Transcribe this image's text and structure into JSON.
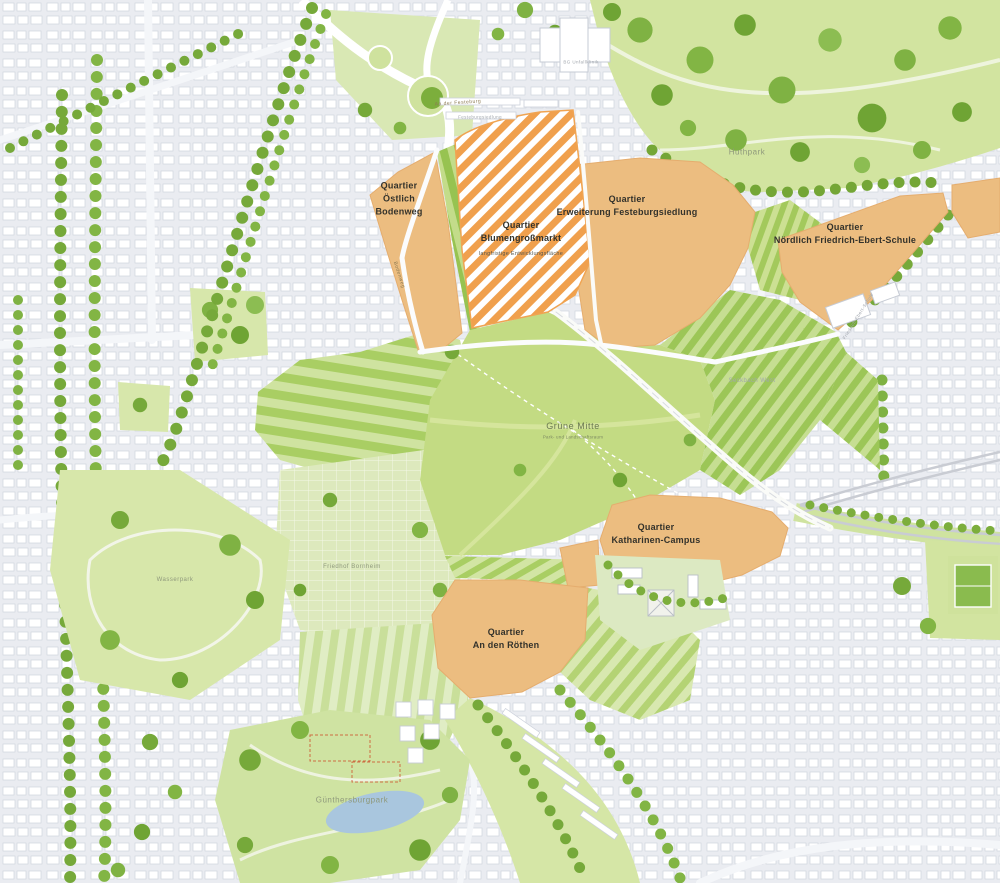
{
  "map": {
    "title": "Masterplan Grüne Mitte / Quartiere",
    "quarters": [
      {
        "id": "oestlich-bodenweg",
        "label": "Quartier\nÖstlich\nBodenweg"
      },
      {
        "id": "blumengrossmarkt",
        "label": "Quartier\nBlumengroßmarkt",
        "sublabel": "langfristige Entwicklungsfläche"
      },
      {
        "id": "erweiterung-festeburgsiedlung",
        "label": "Quartier\nErweiterung Festeburgsiedlung"
      },
      {
        "id": "noerdlich-friedrich-ebert-schule",
        "label": "Quartier\nNördlich Friedrich-Ebert-Schule"
      },
      {
        "id": "katharinen-campus",
        "label": "Quartier\nKatharinen-Campus"
      },
      {
        "id": "an-den-roethen",
        "label": "Quartier\nAn den Röthen"
      }
    ],
    "places": [
      {
        "id": "gruene-mitte",
        "label": "Grüne Mitte",
        "sublabel": "Park- und Landschaftsraum"
      },
      {
        "id": "huthpark",
        "label": "Huthpark"
      },
      {
        "id": "wasserpark",
        "label": "Wasserpark"
      },
      {
        "id": "guenthersburgpark",
        "label": "Günthersburgpark"
      },
      {
        "id": "friedhof-bornheim",
        "label": "Friedhof Bornheim"
      },
      {
        "id": "festeburgsiedlung",
        "label": "Festeburgsiedlung"
      },
      {
        "id": "bg-unfallklinik",
        "label": "BG Unfallklinik"
      },
      {
        "id": "seckbach-west",
        "label": "Seckbach West"
      },
      {
        "id": "friedrich-ebert-schule",
        "label": "Friedrich-Ebert-Schule"
      }
    ],
    "streets": [
      {
        "id": "bodenweg",
        "label": "Bodenweg"
      },
      {
        "id": "an-der-festeburg",
        "label": "An der Festeburg"
      }
    ],
    "colors": {
      "quarter_orange": "#ecbd80",
      "hatch_orange": "#f0a04d",
      "park_green": "#d2e4a0",
      "field_green": "#9cc657",
      "tree_green": "#76a93a",
      "urban_gray": "#eaecf1",
      "water_blue": "#a9c6de"
    }
  }
}
